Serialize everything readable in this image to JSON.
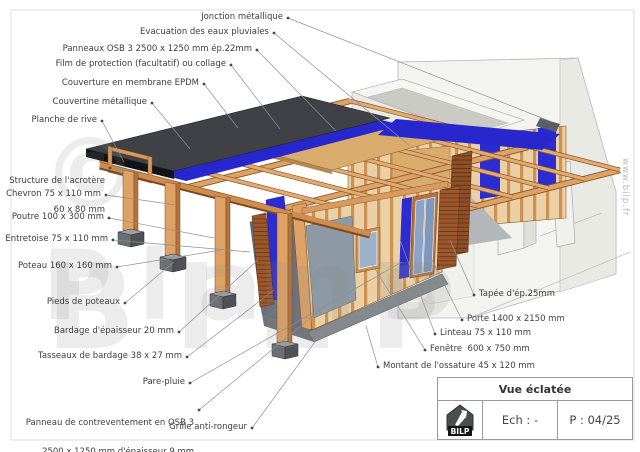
{
  "watermark": {
    "line1": "© Plans",
    "line2": "BILP",
    "website": "www.bilp.fr"
  },
  "title_block": {
    "title": "Vue éclatée",
    "logo": "BILP",
    "scale_label": "Ech : -",
    "page_label": "P : 04/25"
  },
  "colors": {
    "membrane_epdm": "#404147",
    "film_blue": "#2727cd",
    "wood": "#dfa265",
    "osb": "#d9ab6d",
    "cladding": "#9c572b",
    "glass": "#93a9c6",
    "panel_gray": "#8d99a4",
    "building": "#f3f3f0",
    "leader": "#909090"
  },
  "labels_left": [
    {
      "text": "Jonction métallique"
    },
    {
      "text": "Evacuation des eaux pluviales"
    },
    {
      "text": "Panneaux OSB 3 2500 x 1250 mm ép.22mm"
    },
    {
      "text": "Film de protection (facultatif) ou collage"
    },
    {
      "text": "Couverture en membrane EPDM"
    },
    {
      "text": "Couvertine métallique"
    },
    {
      "text": "Planche de rive"
    },
    {
      "lines": [
        "Structure de l'acrotère",
        "60 x 80 mm"
      ]
    },
    {
      "text": "Chevron 75 x 110 mm"
    },
    {
      "text": "Poutre 100 x 300 mm"
    },
    {
      "text": "Entretoise 75 x 110 mm"
    },
    {
      "text": "Poteau 160 x 160 mm"
    },
    {
      "text": "Pieds de poteaux"
    },
    {
      "text": "Bardage d'épaisseur 20 mm"
    },
    {
      "text": "Tasseaux de bardage 38 x 27 mm"
    },
    {
      "text": "Pare-pluie"
    },
    {
      "lines": [
        "Panneau de contreventement en OSB 3",
        "2500 x 1250 mm d'épaisseur 9 mm"
      ]
    },
    {
      "text": "Grille anti-rongeur"
    }
  ],
  "labels_right": [
    {
      "text": "Tapée d'ép.25mm"
    },
    {
      "text": "Porte 1400 x 2150 mm"
    },
    {
      "text": "Linteau 75 x 110 mm"
    },
    {
      "text": "Fenêtre  600 x 750 mm"
    },
    {
      "text": "Montant de l'ossature 45 x 120 mm"
    }
  ]
}
